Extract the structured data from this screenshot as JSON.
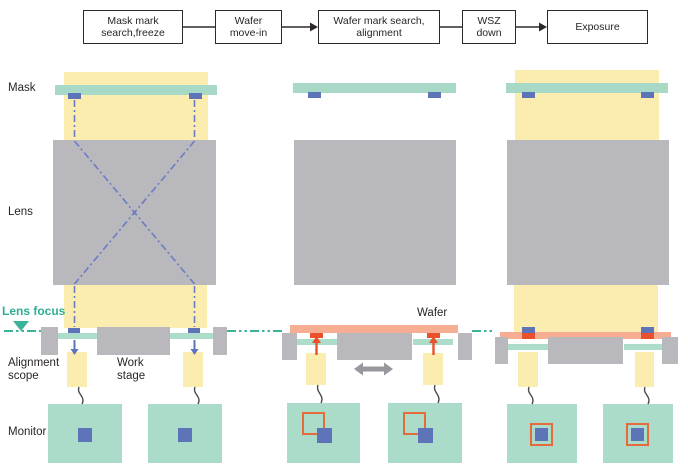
{
  "flow": {
    "steps": [
      {
        "label": "Mask mark\nsearch,freeze"
      },
      {
        "label": "Wafer\nmove-in"
      },
      {
        "label": "Wafer mark search,\nalignment"
      },
      {
        "label": "WSZ\ndown"
      },
      {
        "label": "Exposure"
      }
    ]
  },
  "labels": {
    "mask": "Mask",
    "lens": "Lens",
    "lens_focus": "Lens focus",
    "alignment_scope": "Alignment\nscope",
    "work_stage": "Work\nstage",
    "monitor": "Monitor",
    "wafer": "Wafer"
  },
  "icons": {
    "flow-arrow": "→",
    "scope-view-down-arrow": "↓",
    "wafer-mark-up-arrow": "↑",
    "stage-move-arrow": "↔",
    "lens-focus-marker": "▼"
  },
  "colors": {
    "illumination_yellow": "#FBECAF",
    "mask_teal": "#A8D8C6",
    "monitor_teal": "#AADCC9",
    "lens_gray": "#B8B8BD",
    "mark_blue": "#5D74B9",
    "projection_line_blue": "#6B7CC4",
    "wafer_salmon": "#F6AD92",
    "wafer_mark_red": "#E8512C",
    "monitor_outline_orange": "#E76A3C",
    "focus_teal": "#2EAE95",
    "text_dark": "#2A2527"
  }
}
